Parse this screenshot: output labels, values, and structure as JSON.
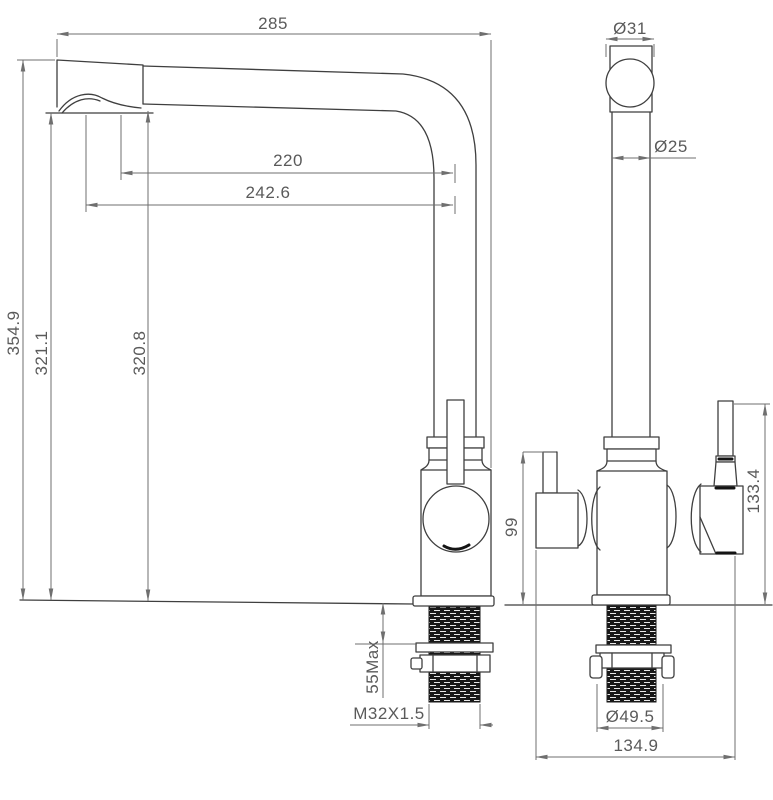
{
  "drawing": {
    "dimensions": {
      "overall_width": "285",
      "spout_reach": "220",
      "spout_reach_outer": "242.6",
      "overall_height": "354.9",
      "height_to_aerator": "321.1",
      "height_to_spout": "320.8",
      "head_diameter": "Ø31",
      "tube_diameter": "Ø25",
      "side_lever_height": "99",
      "handle_height": "133.4",
      "deck_thickness_max": "55Max",
      "shank_thread": "M32X1.5",
      "flange_diameter": "Ø49.5",
      "footprint_width": "134.9"
    },
    "colors": {
      "object_line": "#3f3f3f",
      "dimension_line": "#6f6f6f",
      "text": "#5a5a5a",
      "background": "#ffffff",
      "thread_fill": "#181818"
    }
  }
}
